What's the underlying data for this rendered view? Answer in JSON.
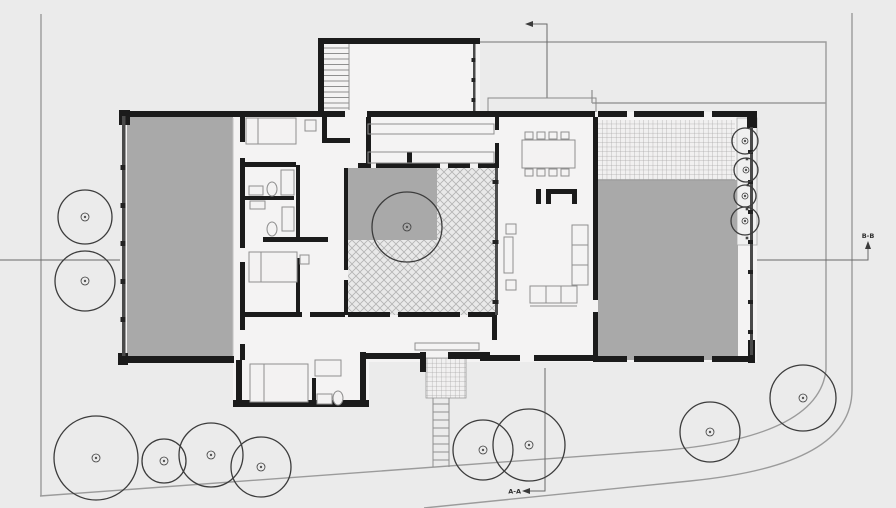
{
  "drawing": {
    "type": "architectural ground floor plan, corner lot with trees",
    "section_markers": {
      "aa": {
        "label": "A-A",
        "arrow": "left"
      },
      "bb": {
        "label": "B-B",
        "arrow": "up"
      }
    }
  },
  "colors": {
    "background": "#ebebeb",
    "wall": "#1b1b1b",
    "room_fill": "#a9a9a9",
    "boundary_line": "#9b9b9b",
    "tree": "#3c3c3c",
    "hatch_line": "#b3b3b3",
    "grid_line": "#a5a5a5",
    "furniture_line": "#8f8f8f"
  },
  "areas": {
    "west_room": "solid-gray",
    "east_terrace": "solid-gray",
    "tiled_terrace": "square-grid",
    "entry_porch": "square-grid",
    "courtyard": "crosshatch",
    "courtyard_planter": "solid-gray"
  },
  "site": {
    "trees": [
      {
        "x": 85,
        "y": 217,
        "r": 27
      },
      {
        "x": 85,
        "y": 281,
        "r": 30
      },
      {
        "x": 96,
        "y": 458,
        "r": 42
      },
      {
        "x": 164,
        "y": 461,
        "r": 22
      },
      {
        "x": 211,
        "y": 455,
        "r": 32
      },
      {
        "x": 261,
        "y": 467,
        "r": 30
      },
      {
        "x": 483,
        "y": 450,
        "r": 30
      },
      {
        "x": 529,
        "y": 445,
        "r": 36
      },
      {
        "x": 710,
        "y": 432,
        "r": 30
      },
      {
        "x": 803,
        "y": 398,
        "r": 33
      },
      {
        "x": 745,
        "y": 141,
        "r": 13
      },
      {
        "x": 746,
        "y": 170,
        "r": 12
      },
      {
        "x": 745,
        "y": 196,
        "r": 11
      },
      {
        "x": 745,
        "y": 221,
        "r": 14
      },
      {
        "x": 407,
        "y": 227,
        "r": 35
      }
    ],
    "planter_dots": [
      [
        747,
        159
      ],
      [
        748,
        185
      ],
      [
        747,
        209
      ],
      [
        747,
        238
      ]
    ]
  }
}
